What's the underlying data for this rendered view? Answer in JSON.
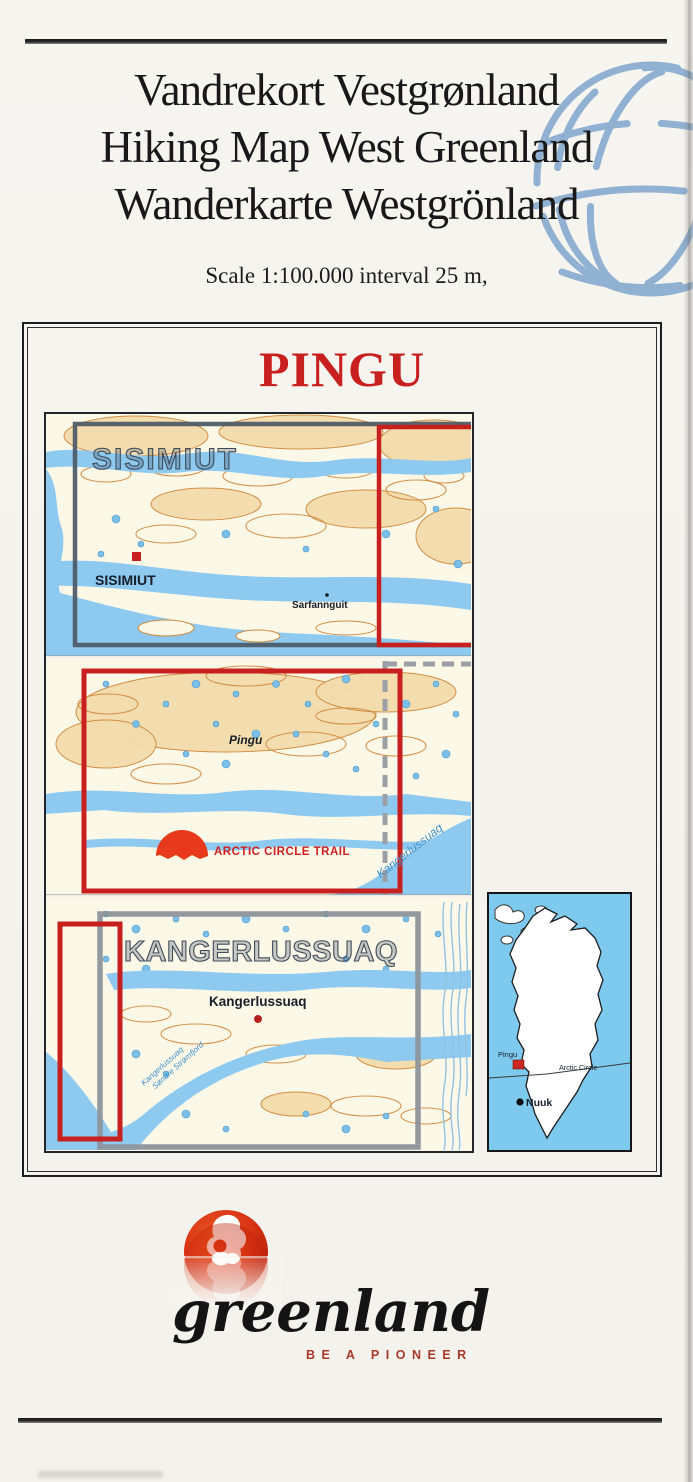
{
  "header": {
    "title_line1": "Vandrekort Vestgrønland",
    "title_line2": "Hiking Map West Greenland",
    "title_line3": "Wanderkarte Westgrönland",
    "scale_note": "Scale 1:100.000 interval 25 m,"
  },
  "cover": {
    "sheet_title": "PINGU"
  },
  "map": {
    "sheet_sisimiut": "SISIMIUT",
    "town_sisimiut": "SISIMIUT",
    "town_sarfannguit": "Sarfannguit",
    "place_pingu": "Pingu",
    "trail": "ARCTIC CIRCLE TRAIL",
    "fjord_kangerlussuaq": "Kangerlussuaq",
    "sheet_kangerlussuaq": "KANGERLUSSUAQ",
    "town_kangerlussuaq": "Kangerlussuaq",
    "fjord_sw_line1": "Kangerlussuaq",
    "fjord_sw_line2": "Søndre Strømfjord"
  },
  "inset": {
    "place_pingu": "Pingu",
    "arctic_circle": "Arctic Circle",
    "town_nuuk": "Nuuk"
  },
  "footer": {
    "brand": "greenland",
    "tagline": "BE A PIONEER"
  },
  "colors": {
    "accent_red": "#c8201f",
    "water_blue": "#8ecaef",
    "contour_orange": "#cf8a3e",
    "land_tan": "#f3dcab",
    "sheet_slate": "#46525e",
    "inset_sea": "#7ec9ee",
    "logo_red": "#d23415",
    "tagline_red": "#a8392a",
    "globe_blue": "#7ba3cc"
  }
}
